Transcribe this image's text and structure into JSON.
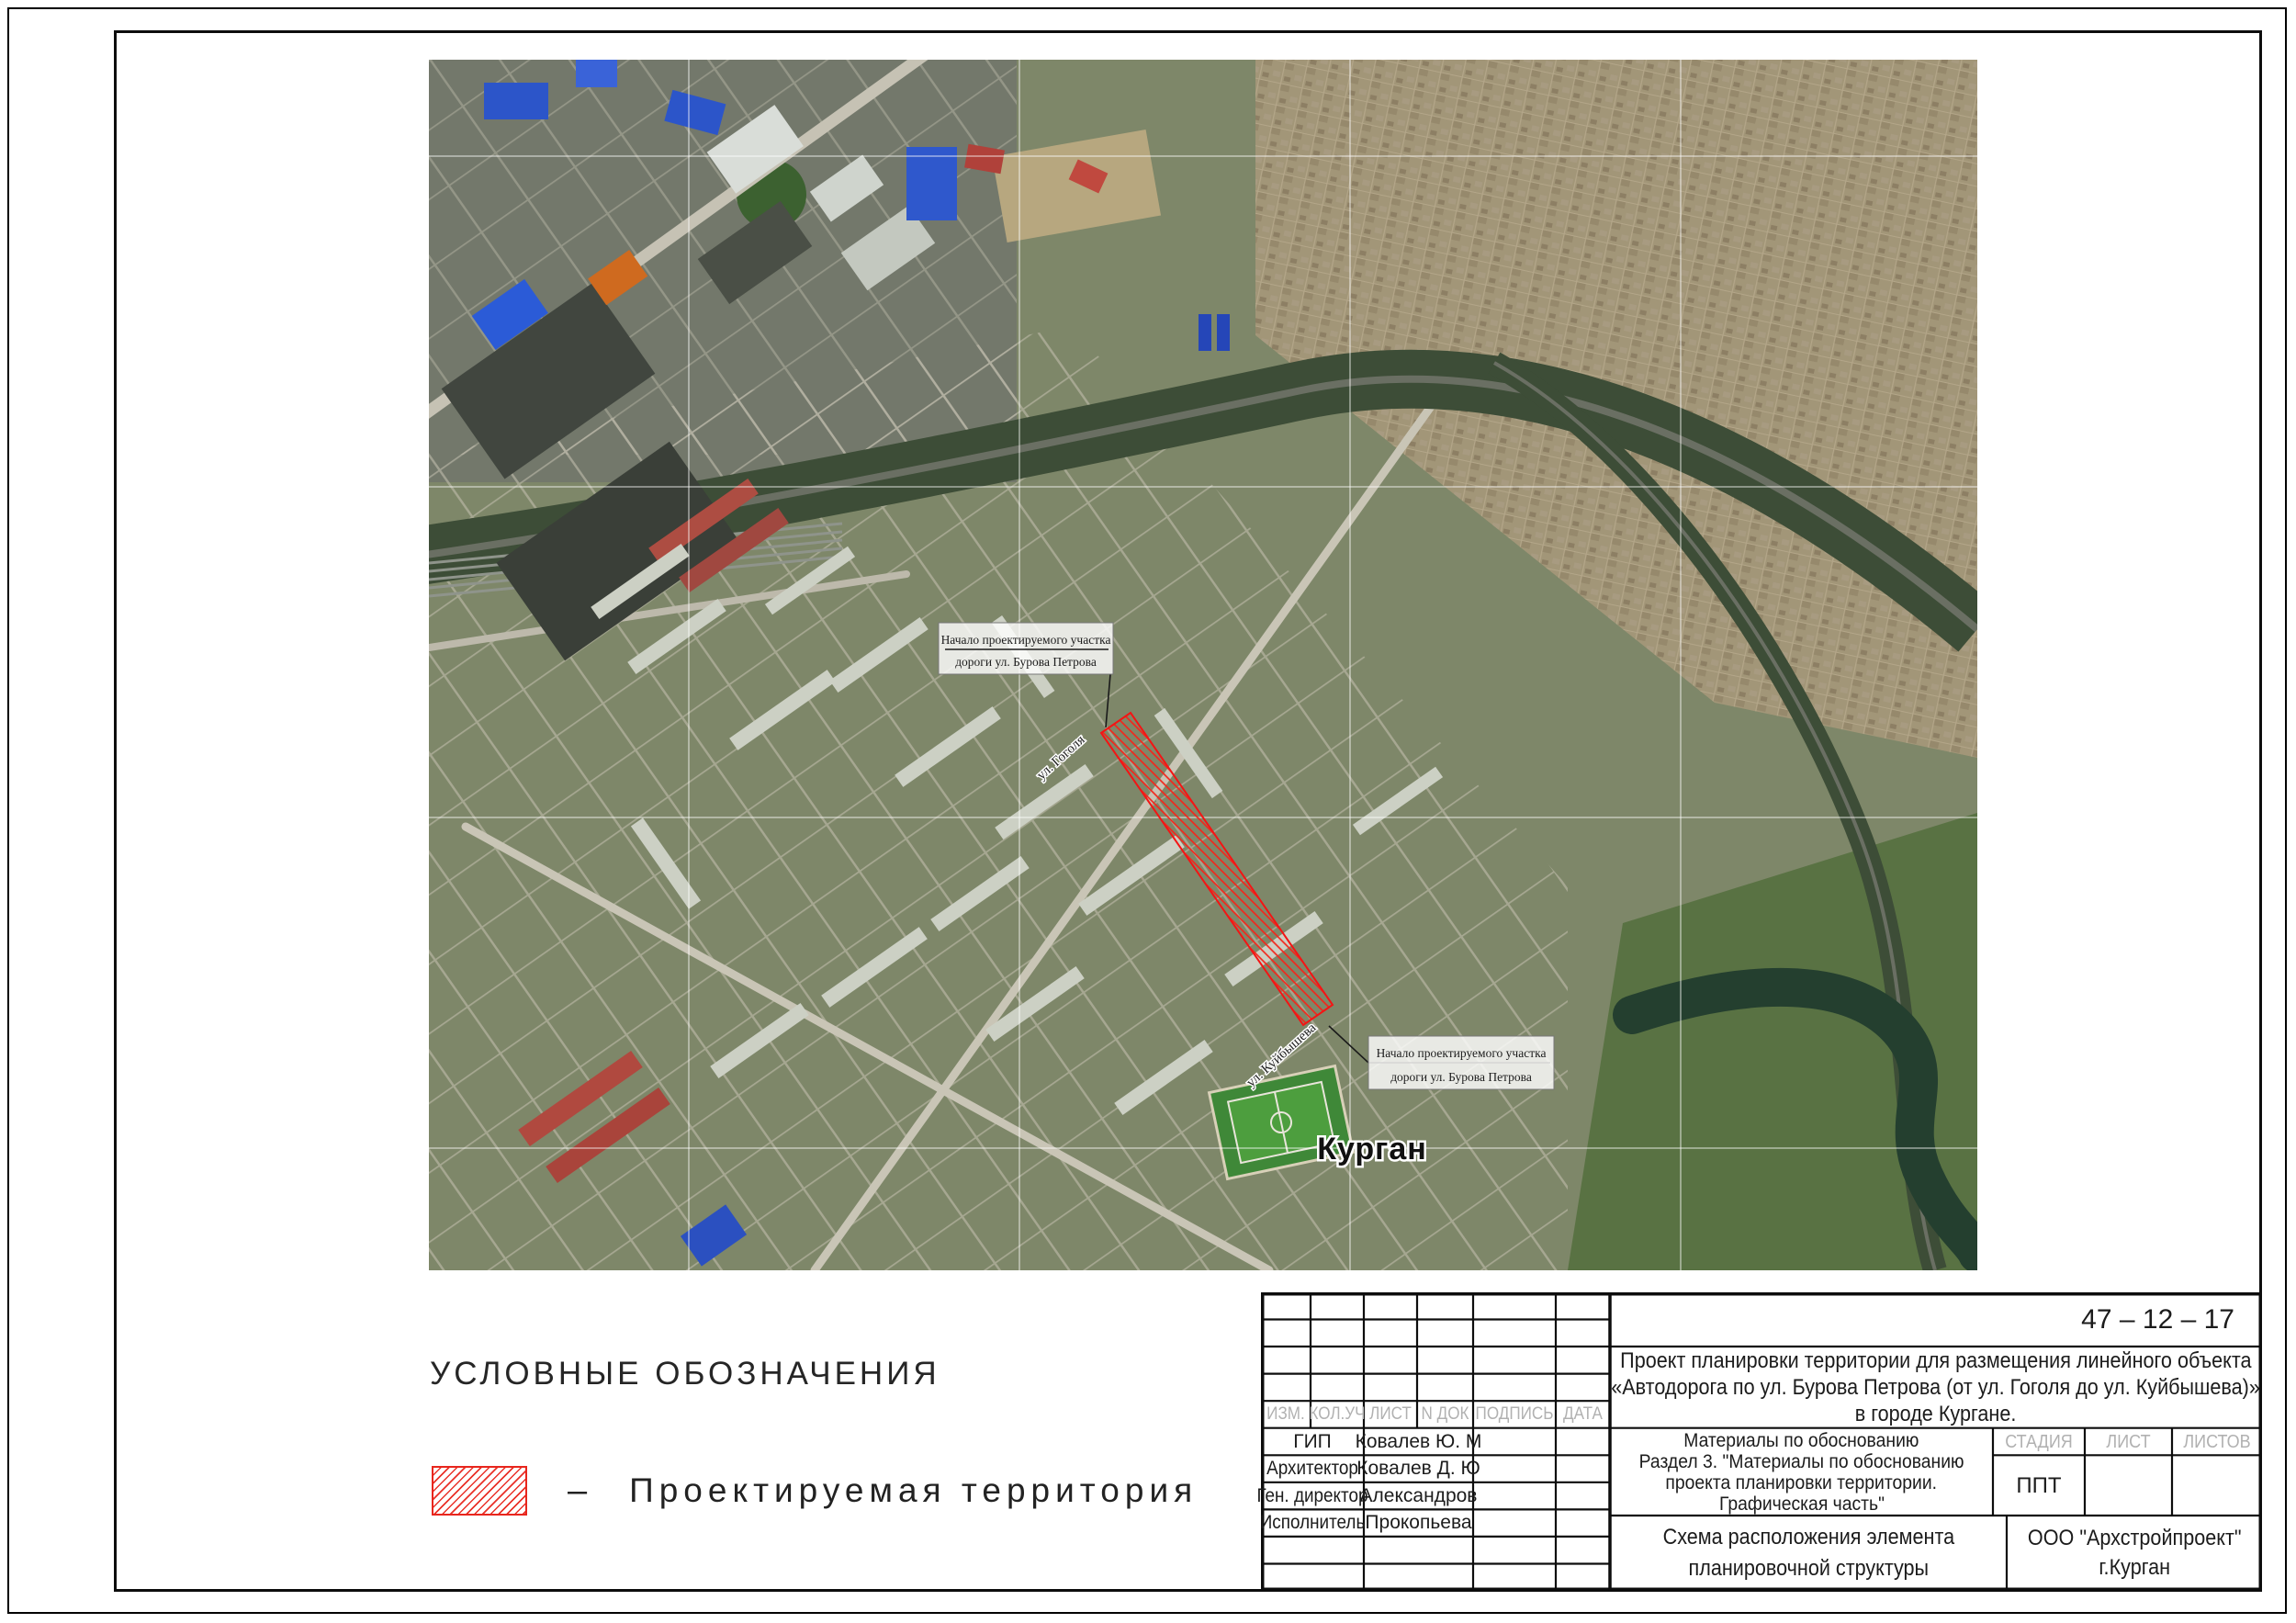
{
  "map": {
    "city_label": "Курган",
    "street_labels": [
      "ул. Гоголя",
      "ул. Куйбышева"
    ],
    "callouts": [
      {
        "line1": "Начало проектируемого участка",
        "line2": "дороги ул. Бурова Петрова"
      },
      {
        "line1": "Начало проектируемого участка",
        "line2": "дороги ул. Бурова Петрова"
      }
    ]
  },
  "legend": {
    "title": "УСЛОВНЫЕ ОБОЗНАЧЕНИЯ",
    "items": [
      {
        "swatch": "red-diagonal-hatch",
        "dash": "–",
        "label": "Проектируемая территория"
      }
    ]
  },
  "title_block": {
    "doc_number": "47 – 12 – 17",
    "project_title_lines": [
      "Проект планировки территории для размещения линейного объекта",
      "«Автодорога по ул. Бурова Петрова (от ул. Гоголя до ул. Куйбышева)»",
      "в городе Кургане."
    ],
    "revision_headers": [
      "ИЗМ.",
      "КОЛ.УЧ",
      "ЛИСТ",
      "N  ДОК",
      "ПОДПИСЬ",
      "ДАТА"
    ],
    "staff": [
      {
        "role": "ГИП",
        "name": "Ковалев Ю. М"
      },
      {
        "role": "Архитектор",
        "name": "Ковалев Д. Ю"
      },
      {
        "role": "Ген. директор",
        "name": "Александров"
      },
      {
        "role": "Исполнитель",
        "name": "Прокопьева"
      }
    ],
    "section_lines": [
      "Материалы по обоснованию",
      "Раздел 3. \"Материалы по обоснованию",
      "проекта планировки территории.",
      "Графическая часть\""
    ],
    "stage_headers": [
      "СТАДИЯ",
      "ЛИСТ",
      "ЛИСТОВ"
    ],
    "stage_value": "ППТ",
    "sheet_name_lines": [
      "Схема расположения элемента",
      "планировочной структуры"
    ],
    "company_lines": [
      "ООО \"Архстройпроект\"",
      "г.Курган"
    ]
  },
  "colors": {
    "accent_red": "#e8261d",
    "header_gray": "#b1b1b1",
    "map_base_green": "#7e8769",
    "river_dark": "#243f2f"
  }
}
